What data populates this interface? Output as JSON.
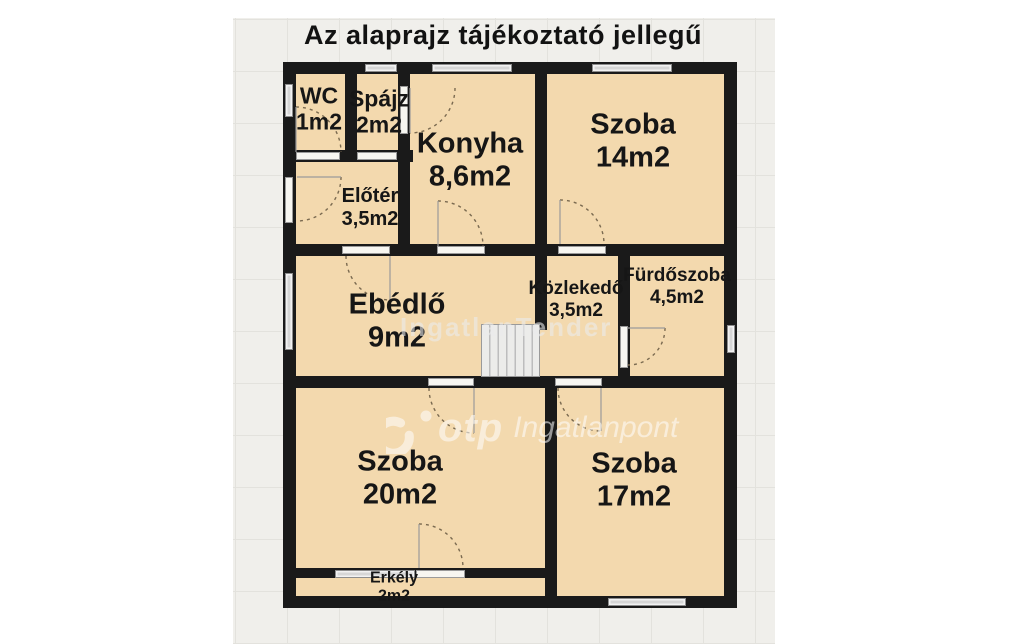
{
  "title": "Az alaprajz tájékoztató jellegű",
  "rooms": [
    {
      "name": "WC",
      "area": "1m2"
    },
    {
      "name": "Spájz",
      "area": "2m2"
    },
    {
      "name": "Konyha",
      "area": "8,6m2"
    },
    {
      "name": "Szoba",
      "area": "14m2"
    },
    {
      "name": "Előtér",
      "area": "3,5m2"
    },
    {
      "name": "Ebédlő",
      "area": "9m2"
    },
    {
      "name": "Közlekedő",
      "area": "3,5m2"
    },
    {
      "name": "Fürdőszoba",
      "area": "4,5m2"
    },
    {
      "name": "Szoba",
      "area": "20m2"
    },
    {
      "name": "Szoba",
      "area": "17m2"
    },
    {
      "name": "Erkély",
      "area": "2m2"
    }
  ],
  "watermarks": {
    "tender": "IngatlanTender",
    "otp": "otp",
    "otp_suffix": "Ingatlanpont"
  },
  "colors": {
    "room_fill": "#f3d9ae",
    "wall": "#1a1a1a",
    "window_gray": "#d6d6d6",
    "canvas_bg": "#f0efeb",
    "page_bg": "#ffffff"
  }
}
